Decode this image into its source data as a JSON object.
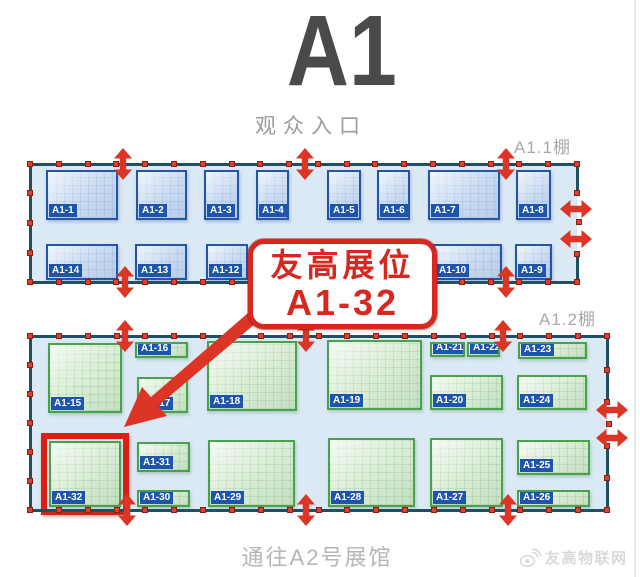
{
  "title": "A1",
  "labels": {
    "entrance": "观众入口",
    "hall1": "A1.1棚",
    "hall2": "A1.2棚",
    "exit": "通往A2号展馆",
    "watermark": "友高物联网"
  },
  "callout": {
    "line1": "友高展位",
    "line2": "A1-32"
  },
  "colors": {
    "red": "#dc3526",
    "highlight_ring": "#da2012",
    "hall_fill": "#dbe9f4",
    "hall_border": "#1e4f63",
    "booth_blue_fill": "#cadbf1",
    "booth_blue_border": "#2356a7",
    "booth_green_fill": "#d9ecd4",
    "booth_green_border": "#46a24b",
    "tag_bg": "#1d55ad",
    "callout_red": "#d6281e",
    "title_gray": "#4a4a4a"
  },
  "map": {
    "big_arrow_points": "248,313 151,397 142,387 124,427 167,416 158,406 256,323",
    "halls": [
      {
        "id": "hall1",
        "label": "A1.1棚",
        "theme": "blue",
        "fill": {
          "x": 30,
          "y": 164,
          "w": 547,
          "h": 118
        },
        "border_segments": [
          [
            30,
            164,
            577,
            164
          ],
          [
            30,
            282,
            577,
            282
          ],
          [
            30,
            164,
            30,
            282
          ],
          [
            577,
            164,
            577,
            193
          ],
          [
            577,
            254,
            577,
            282
          ]
        ],
        "handle_edges": [
          {
            "x1": 30,
            "y1": 164,
            "x2": 577,
            "y2": 164,
            "n": 20
          },
          {
            "x1": 30,
            "y1": 282,
            "x2": 577,
            "y2": 282,
            "n": 20
          },
          {
            "x1": 30,
            "y1": 193,
            "x2": 30,
            "y2": 253,
            "n": 3
          },
          {
            "x1": 577,
            "y1": 193,
            "x2": 577,
            "y2": 193,
            "n": 1
          },
          {
            "x1": 579,
            "y1": 222,
            "x2": 579,
            "y2": 222,
            "n": 1
          },
          {
            "x1": 577,
            "y1": 254,
            "x2": 577,
            "y2": 254,
            "n": 1
          }
        ],
        "arrows": [
          {
            "dir": "v",
            "x": 123,
            "y": 164
          },
          {
            "dir": "v",
            "x": 305,
            "y": 164
          },
          {
            "dir": "v",
            "x": 506,
            "y": 164
          },
          {
            "dir": "v",
            "x": 125,
            "y": 282
          },
          {
            "dir": "v",
            "x": 506,
            "y": 282
          },
          {
            "dir": "h",
            "x": 576,
            "y": 209
          },
          {
            "dir": "h",
            "x": 576,
            "y": 239
          }
        ],
        "booths": [
          {
            "label": "A1-1",
            "x": 46,
            "y": 170,
            "w": 72,
            "h": 50
          },
          {
            "label": "A1-2",
            "x": 136,
            "y": 170,
            "w": 51,
            "h": 50
          },
          {
            "label": "A1-3",
            "x": 204,
            "y": 170,
            "w": 35,
            "h": 50
          },
          {
            "label": "A1-4",
            "x": 256,
            "y": 170,
            "w": 33,
            "h": 50
          },
          {
            "label": "A1-5",
            "x": 327,
            "y": 170,
            "w": 34,
            "h": 50
          },
          {
            "label": "A1-6",
            "x": 377,
            "y": 170,
            "w": 33,
            "h": 50
          },
          {
            "label": "A1-7",
            "x": 428,
            "y": 170,
            "w": 72,
            "h": 50
          },
          {
            "label": "A1-8",
            "x": 516,
            "y": 170,
            "w": 35,
            "h": 50
          },
          {
            "label": "A1-14",
            "x": 46,
            "y": 244,
            "w": 72,
            "h": 36
          },
          {
            "label": "A1-13",
            "x": 135,
            "y": 244,
            "w": 52,
            "h": 36
          },
          {
            "label": "A1-12",
            "x": 206,
            "y": 244,
            "w": 42,
            "h": 36
          },
          {
            "label": "A1-10",
            "x": 433,
            "y": 244,
            "w": 69,
            "h": 36
          },
          {
            "label": "A1-9",
            "x": 515,
            "y": 244,
            "w": 37,
            "h": 36
          }
        ]
      },
      {
        "id": "hall2",
        "label": "A1.2棚",
        "theme": "green",
        "fill": {
          "x": 30,
          "y": 336,
          "w": 577,
          "h": 174
        },
        "border_segments": [
          [
            30,
            336,
            607,
            336
          ],
          [
            30,
            510,
            607,
            510
          ],
          [
            30,
            336,
            30,
            510
          ],
          [
            607,
            336,
            607,
            403
          ],
          [
            607,
            445,
            607,
            510
          ]
        ],
        "handle_edges": [
          {
            "x1": 30,
            "y1": 336,
            "x2": 607,
            "y2": 336,
            "n": 21
          },
          {
            "x1": 30,
            "y1": 510,
            "x2": 607,
            "y2": 510,
            "n": 21
          },
          {
            "x1": 30,
            "y1": 365,
            "x2": 30,
            "y2": 481,
            "n": 5
          },
          {
            "x1": 607,
            "y1": 370,
            "x2": 607,
            "y2": 402,
            "n": 2
          },
          {
            "x1": 609,
            "y1": 424,
            "x2": 609,
            "y2": 424,
            "n": 1
          },
          {
            "x1": 607,
            "y1": 446,
            "x2": 607,
            "y2": 478,
            "n": 2
          }
        ],
        "arrows": [
          {
            "dir": "v",
            "x": 125,
            "y": 336
          },
          {
            "dir": "v",
            "x": 306,
            "y": 336
          },
          {
            "dir": "v",
            "x": 503,
            "y": 336
          },
          {
            "dir": "v",
            "x": 127,
            "y": 510
          },
          {
            "dir": "v",
            "x": 306,
            "y": 510
          },
          {
            "dir": "v",
            "x": 508,
            "y": 510
          },
          {
            "dir": "h",
            "x": 612,
            "y": 410
          },
          {
            "dir": "h",
            "x": 612,
            "y": 438
          }
        ],
        "booths": [
          {
            "label": "A1-15",
            "x": 48,
            "y": 343,
            "w": 74,
            "h": 70
          },
          {
            "label": "A1-16",
            "x": 135,
            "y": 342,
            "w": 53,
            "h": 16
          },
          {
            "label": "A1-17",
            "x": 137,
            "y": 377,
            "w": 51,
            "h": 36
          },
          {
            "label": "A1-18",
            "x": 207,
            "y": 341,
            "w": 90,
            "h": 70
          },
          {
            "label": "A1-19",
            "x": 327,
            "y": 340,
            "w": 95,
            "h": 70
          },
          {
            "label": "A1-21",
            "x": 430,
            "y": 342,
            "w": 35,
            "h": 15
          },
          {
            "label": "A1-22",
            "x": 467,
            "y": 342,
            "w": 33,
            "h": 15
          },
          {
            "label": "A1-23",
            "x": 518,
            "y": 342,
            "w": 69,
            "h": 17
          },
          {
            "label": "A1-20",
            "x": 430,
            "y": 375,
            "w": 73,
            "h": 35
          },
          {
            "label": "A1-24",
            "x": 517,
            "y": 375,
            "w": 70,
            "h": 35
          },
          {
            "label": "A1-32",
            "x": 49,
            "y": 441,
            "w": 72,
            "h": 66,
            "highlight": true
          },
          {
            "label": "A1-31",
            "x": 137,
            "y": 442,
            "w": 53,
            "h": 30
          },
          {
            "label": "A1-30",
            "x": 137,
            "y": 490,
            "w": 53,
            "h": 17
          },
          {
            "label": "A1-29",
            "x": 208,
            "y": 440,
            "w": 87,
            "h": 67
          },
          {
            "label": "A1-28",
            "x": 328,
            "y": 438,
            "w": 87,
            "h": 69
          },
          {
            "label": "A1-27",
            "x": 430,
            "y": 438,
            "w": 73,
            "h": 69
          },
          {
            "label": "A1-25",
            "x": 517,
            "y": 440,
            "w": 73,
            "h": 35
          },
          {
            "label": "A1-26",
            "x": 517,
            "y": 490,
            "w": 73,
            "h": 17
          }
        ]
      }
    ]
  }
}
